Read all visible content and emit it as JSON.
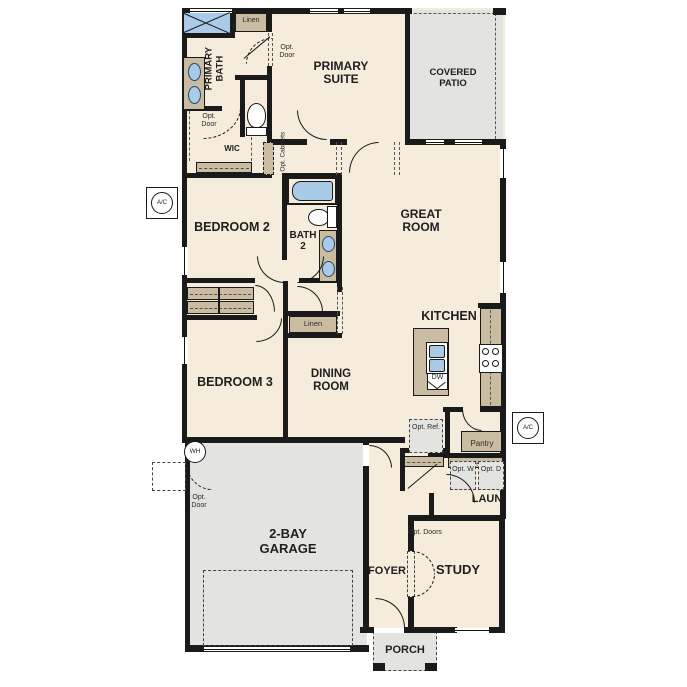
{
  "colors": {
    "floor": "#f5ecdb",
    "gray": "#e3e3e0",
    "wall": "#1a1a1a",
    "tan": "#c9bca1",
    "blue": "#a9cbe8"
  },
  "rooms": {
    "primary_bath": "PRIMARY BATH",
    "primary_suite": "PRIMARY SUITE",
    "covered_patio": "COVERED PATIO",
    "great_room": "GREAT ROOM",
    "bedroom_2": "BEDROOM 2",
    "bath_2": "BATH 2",
    "bedroom_3": "BEDROOM 3",
    "dining_room": "DINING ROOM",
    "kitchen": "KITCHEN",
    "wic": "WIC",
    "laundry": "LAUN",
    "garage": "2-BAY GARAGE",
    "foyer": "FOYER",
    "study": "STUDY",
    "porch": "PORCH"
  },
  "labels": {
    "linen": "Linen",
    "opt_door": "Opt. Door",
    "opt_cabinets": "Opt. Cabinets",
    "opt_ref": "Opt. Ref.",
    "opt_w": "Opt. W",
    "opt_d": "Opt. D",
    "opt_doors": "Opt. Doors",
    "pantry": "Pantry",
    "dw": "DW",
    "wh": "WH",
    "ac": "A/C"
  }
}
